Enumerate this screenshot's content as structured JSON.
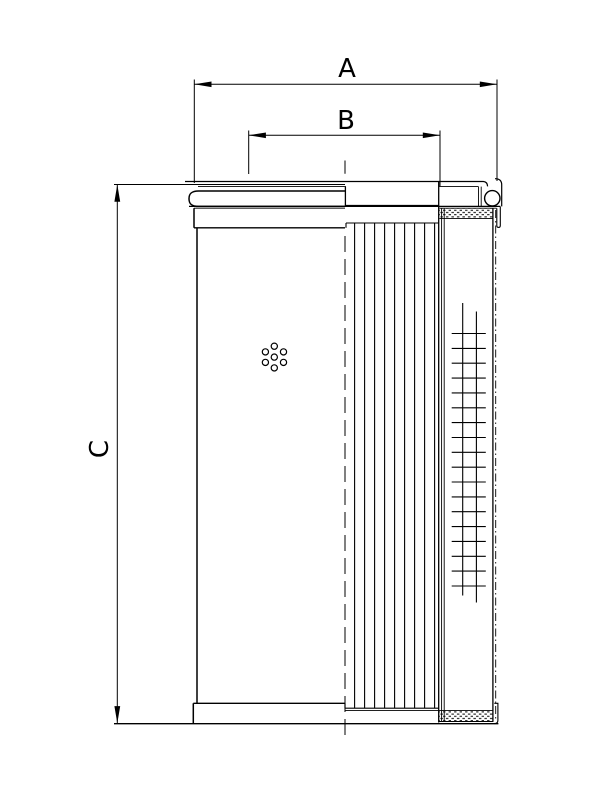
{
  "drawing": {
    "background_color": "#ffffff",
    "line_color": "#000000",
    "dimension_a_label": "A",
    "dimension_b_label": "B",
    "dimension_c_label": "C"
  }
}
